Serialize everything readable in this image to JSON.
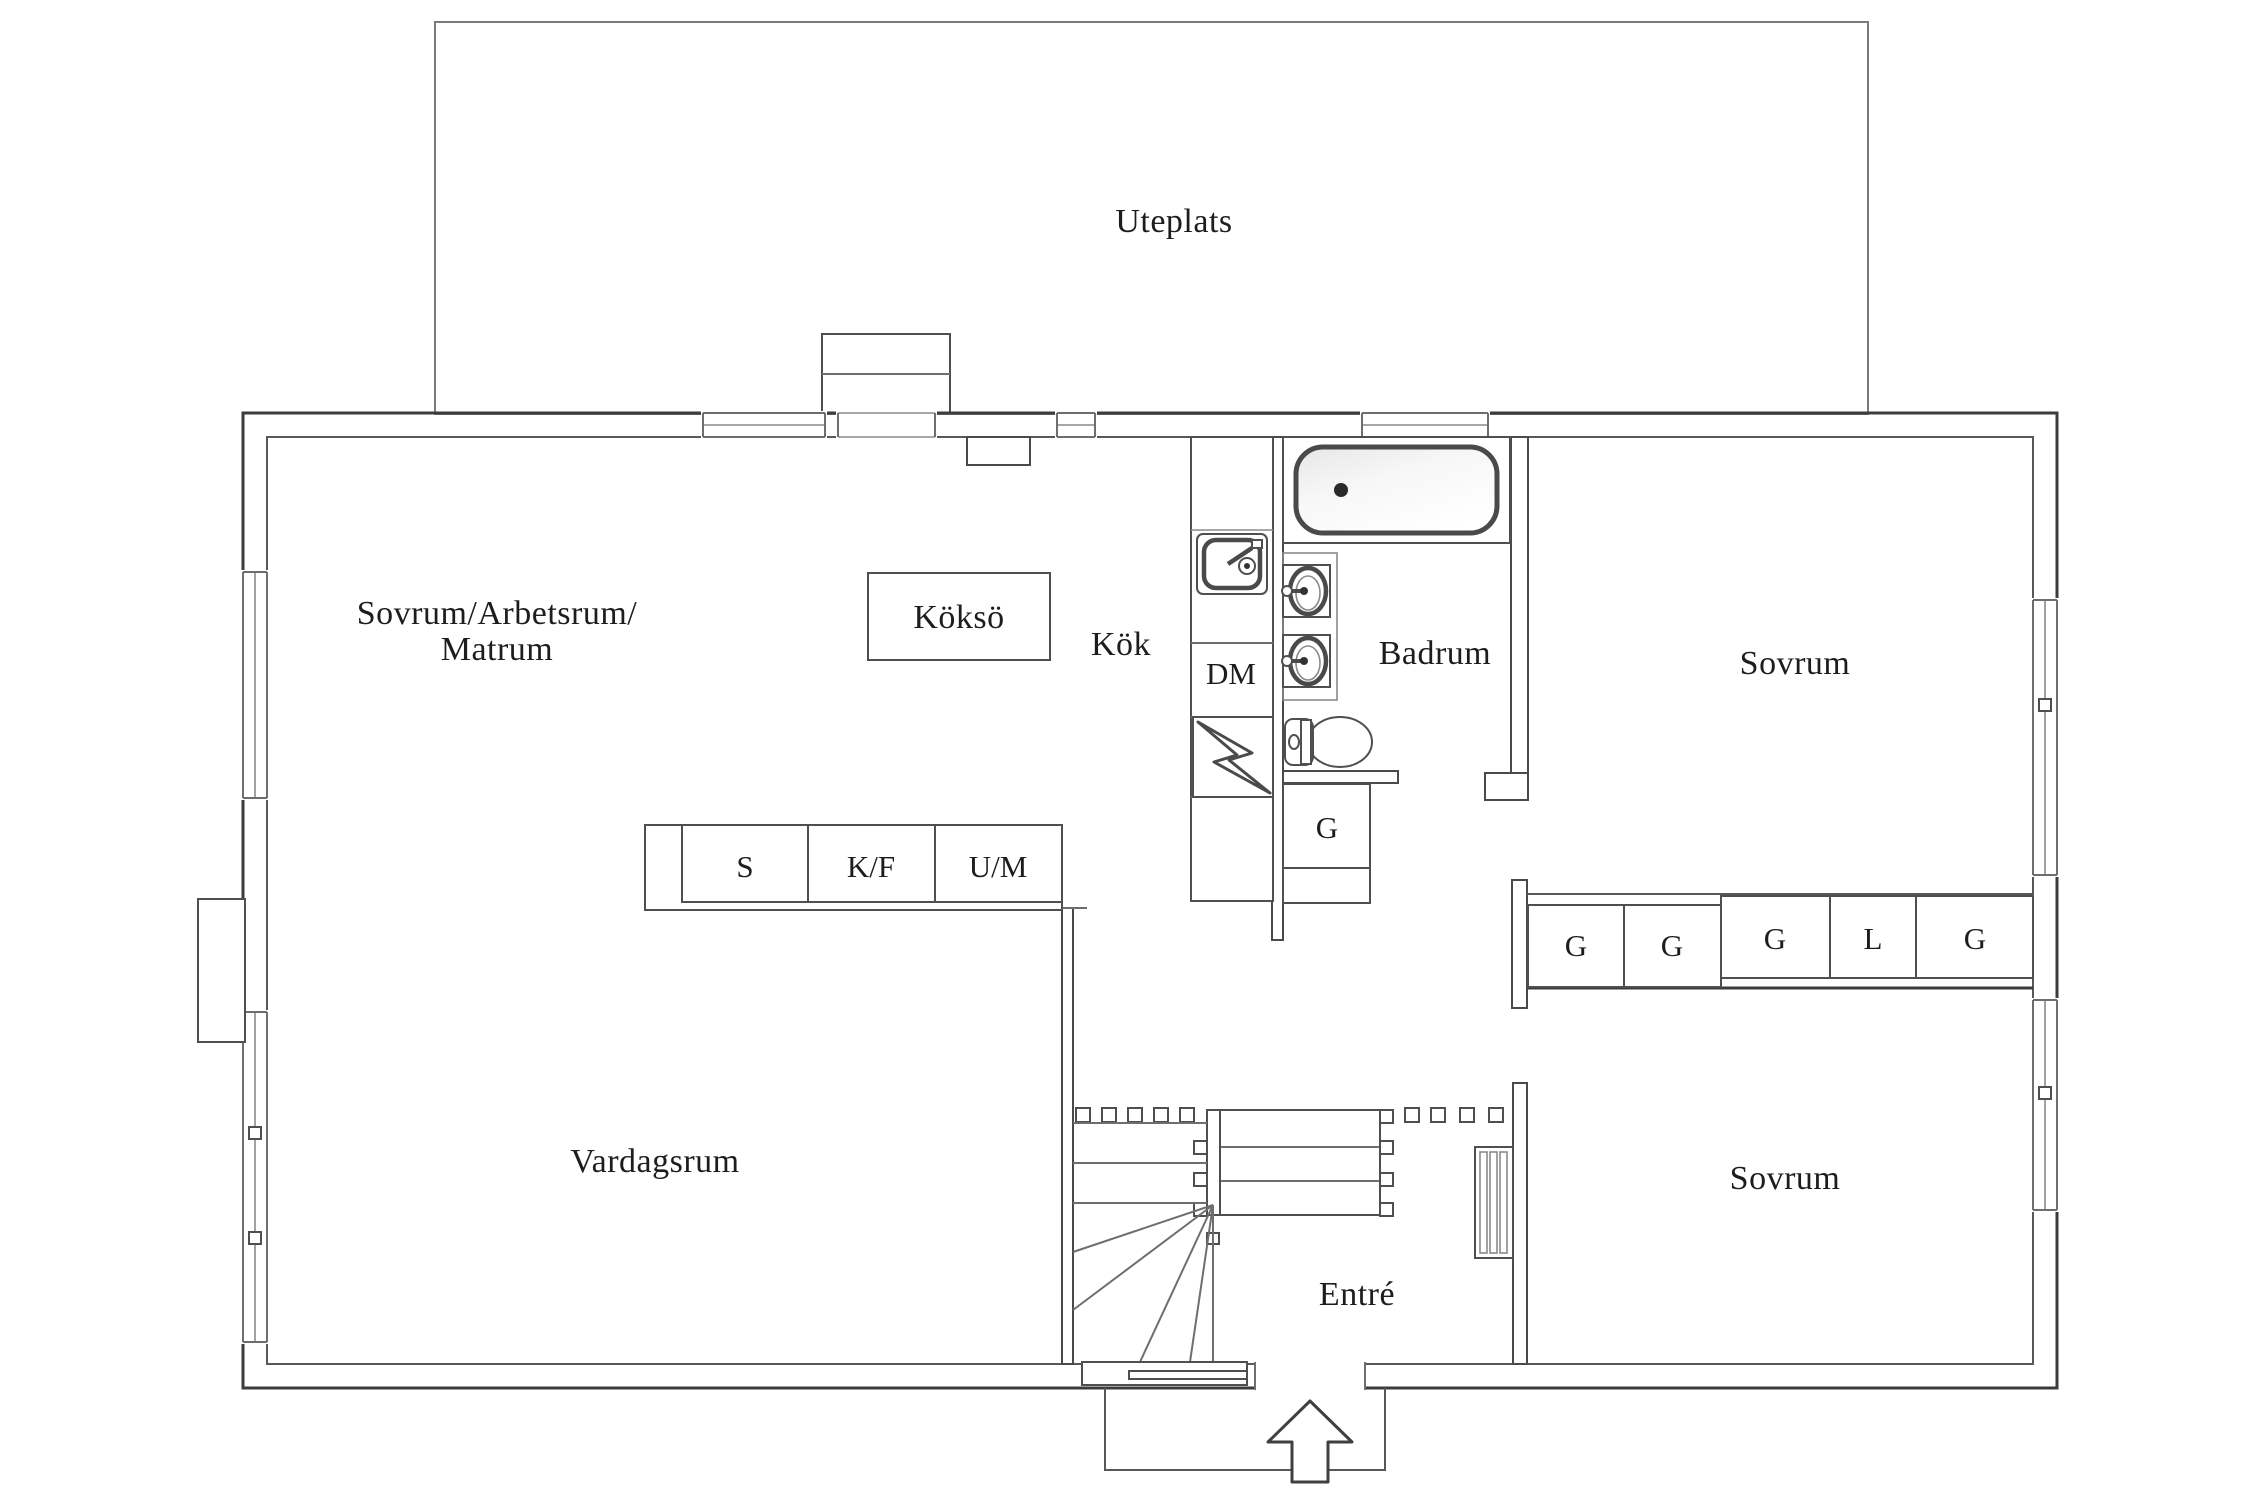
{
  "document": {
    "type": "floor-plan",
    "language": "Swedish"
  },
  "labels": {
    "uteplats": "Uteplats",
    "room_multi_line1": "Sovrum/Arbetsrum/",
    "room_multi_line2": "Matrum",
    "kokso": "Köksö",
    "kok": "Kök",
    "dm": "DM",
    "badrum": "Badrum",
    "sovrum_top": "Sovrum",
    "sovrum_bottom": "Sovrum",
    "vardagsrum": "Vardagsrum",
    "entre": "Entré",
    "bathroom_closet": "G"
  },
  "cabinet_row": [
    "S",
    "K/F",
    "U/M"
  ],
  "closet_row": [
    "G",
    "G",
    "G",
    "L",
    "G"
  ],
  "palette": {
    "background": "#ffffff",
    "wall_line": "#3c3c3c",
    "fixture_line": "#4a4a4a",
    "light_line": "#8a8a8a",
    "text": "#1d1d1d"
  }
}
